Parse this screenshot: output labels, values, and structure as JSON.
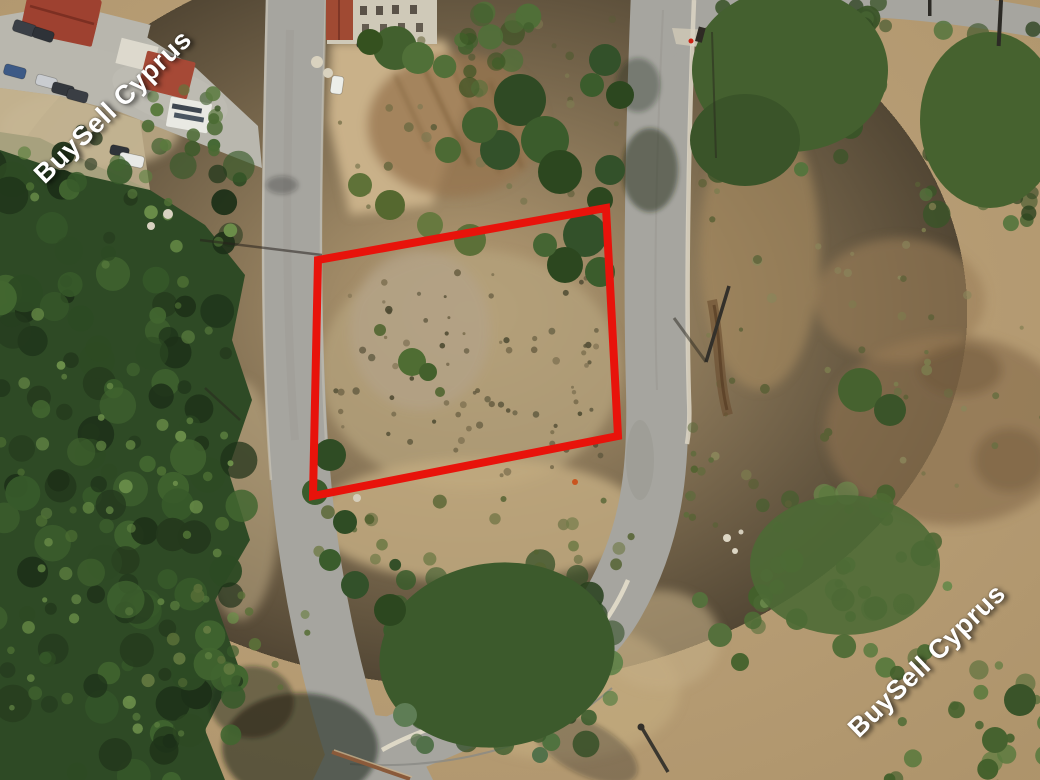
{
  "watermarks": {
    "top_left": {
      "text": "BuySell Cyprus"
    },
    "bottom_right": {
      "text": "BuySell Cyprus"
    },
    "color": "#ffffff"
  },
  "plot_outline": {
    "color": "#e8130b",
    "stroke_width": 8,
    "points": "318,260 606,208 618,436 313,496"
  },
  "palette": {
    "terrain_tan": "#b79d74",
    "road_gray": "#a6a59f",
    "forest_green": "#2e4a25",
    "scrub_olive": "#55703c",
    "roof_red": "#9e4130"
  }
}
